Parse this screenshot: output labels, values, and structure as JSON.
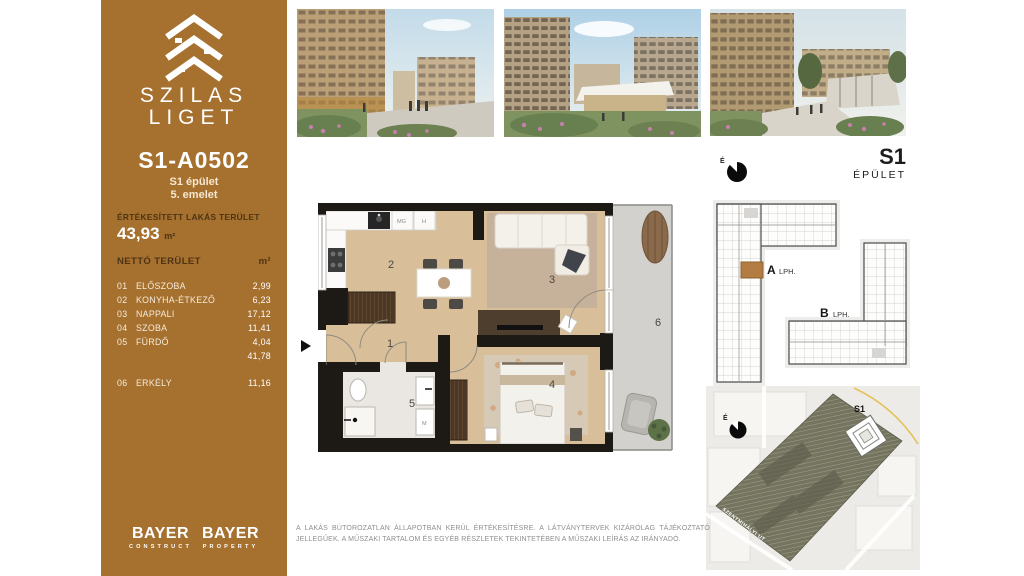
{
  "brand": {
    "name_line1": "SZILAS",
    "name_line2": "LIGET"
  },
  "unit": {
    "code": "S1-A0502",
    "building": "S1 épület",
    "floor": "5. emelet"
  },
  "area_summary": {
    "sold_label": "ÉRTÉKESÍTETT LAKÁS TERÜLET",
    "sold_value": "43,93",
    "sold_unit": "m²",
    "net_label": "NETTÓ TERÜLET",
    "net_unit": "m²"
  },
  "rooms": [
    {
      "num": "01",
      "name": "ELŐSZOBA",
      "area": "2,99"
    },
    {
      "num": "02",
      "name": "KONYHA-ÉTKEZŐ",
      "area": "6,23"
    },
    {
      "num": "03",
      "name": "NAPPALI",
      "area": "17,12"
    },
    {
      "num": "04",
      "name": "SZOBA",
      "area": "11,41"
    },
    {
      "num": "05",
      "name": "FÜRDŐ",
      "area": "4,04"
    }
  ],
  "net_total": "41,78",
  "balcony_row": {
    "num": "06",
    "name": "ERKÉLY",
    "area": "11,16"
  },
  "floorplan": {
    "labels": {
      "hall": "1",
      "kitchen": "2",
      "living": "3",
      "bedroom": "4",
      "bathroom": "5",
      "balcony": "6"
    },
    "appliances": {
      "dishwasher": "MG",
      "fridge": "H",
      "washer": "M"
    }
  },
  "keyplan": {
    "title": "S1",
    "subtitle": "ÉPÜLET",
    "north": "É",
    "core_a_letter": "A",
    "core_a_word": "LPH.",
    "core_b_letter": "B",
    "core_b_word": "LPH."
  },
  "siteplan": {
    "building_label": "S1",
    "street_label": "SZENTMIHÁLYI ÚT",
    "north": "É"
  },
  "footer": {
    "logo1_title": "BAYER",
    "logo1_sub": "CONSTRUCT",
    "logo2_title": "BAYER",
    "logo2_sub": "PROPERTY",
    "disclaimer": "A lakás bútorozatlan állapotban kerül értékesítésre. A látványtervek kizárólag tájékoztató jellegűek. A műszaki tartalom és egyéb részletek tekintetében a műszaki leírás az irányadó."
  },
  "colors": {
    "sidebar_bg": "#a6702f",
    "sidebar_text_dark": "#4d3414",
    "sidebar_text_light": "#f6ecd9",
    "wall": "#1d1a16",
    "wood_floor": "#d9bf99",
    "balcony_floor": "#d2d1cd",
    "unit_highlight": "#b27c42"
  }
}
